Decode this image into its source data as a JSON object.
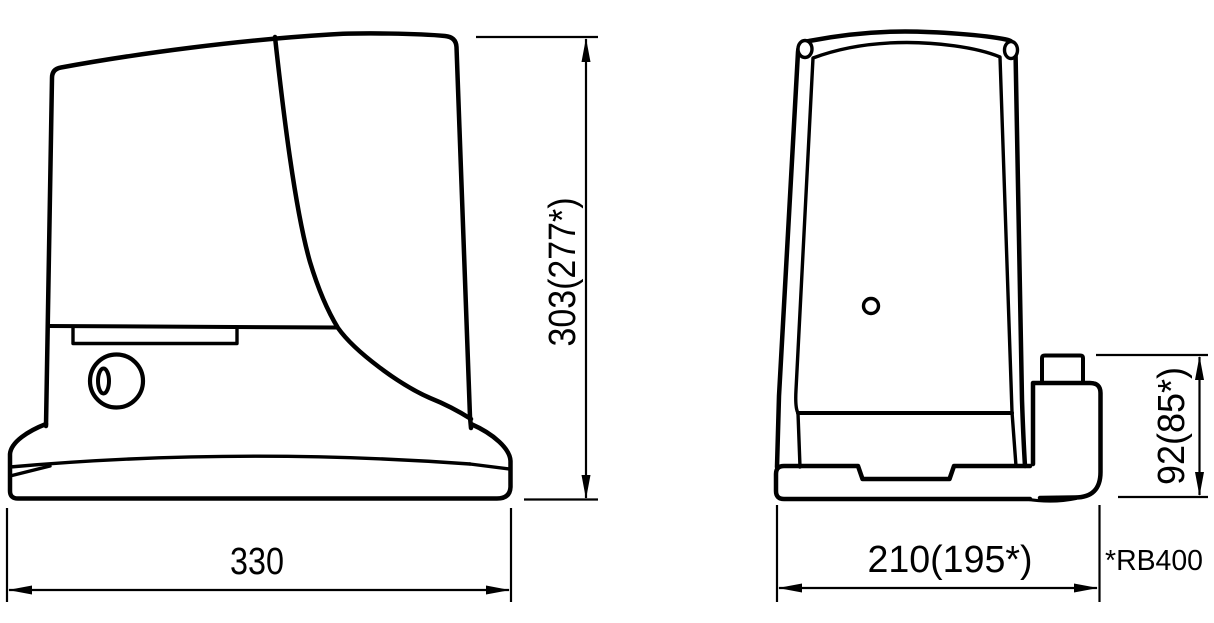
{
  "drawing": {
    "type": "technical-dimension-drawing",
    "background_color": "#ffffff",
    "line_color": "#000000",
    "side_view": {
      "name": "gearmotor side view",
      "width_dim": "330",
      "height_dim": "303(277*)"
    },
    "front_view": {
      "name": "gearmotor front view",
      "width_dim": "210(195*)",
      "rear_block_height_dim": "92(85*)"
    },
    "footnote": "*RB400"
  }
}
